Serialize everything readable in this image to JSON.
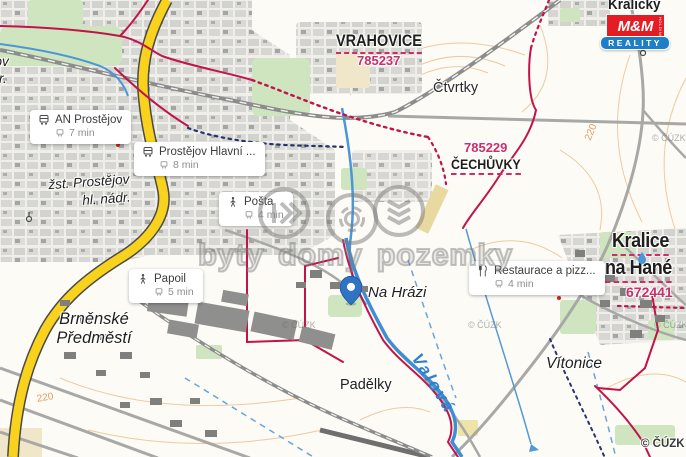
{
  "map": {
    "attribution": "© ČÚZK",
    "faint_mark": "© ČÚZK",
    "labels": {
      "vrahovice": "VRAHOVICE",
      "vrahovice_code": "785237",
      "ctvrtky": "Čtvrtky",
      "cechuvky": "ČECHŮVKY",
      "cechuvky_code": "785229",
      "kralicky": "Kralický",
      "kralice_line1": "Kralice",
      "kralice_line2": "na Hané",
      "kralice_code": "672441",
      "vitonice": "Vítonice",
      "padelky": "Padělky",
      "na_hrazi": "Na Hrázi",
      "brnenske_line1": "Brněnské",
      "brnenske_line2": "Předměstí",
      "station_line1": "žst. Prostějov",
      "station_line2": "hl. nádr.",
      "edge_partial_line1": "ějov",
      "edge_partial_line2": "ádr.",
      "river": "Valová",
      "contour_a": "220",
      "contour_b": "220"
    }
  },
  "callouts": [
    {
      "icon": "bus",
      "title": "AN Prostějov",
      "time": "7 min"
    },
    {
      "icon": "bus",
      "title": "Prostějov Hlavní ...",
      "time": "8 min"
    },
    {
      "icon": "walk",
      "title": "Pošta",
      "time": "4 min"
    },
    {
      "icon": "walk",
      "title": "Papoil",
      "time": "5 min"
    },
    {
      "icon": "restaurant",
      "title": "Restaurace a pizz...",
      "time": "4 min"
    }
  ],
  "watermark": {
    "text": "byty domy pozemky"
  },
  "logo": {
    "mm": "M&M",
    "holding": "HOLDING",
    "reality": "REALITY"
  },
  "colors": {
    "cadastral_pink": "#cb2e6a",
    "boundary_crimson": "#c2134b",
    "water_blue": "#3e8ed2",
    "road_yellow": "#f8d21c",
    "pin_blue": "#2e73c4",
    "mm_red": "#e31d23",
    "mm_blue": "#1e7ec8"
  }
}
